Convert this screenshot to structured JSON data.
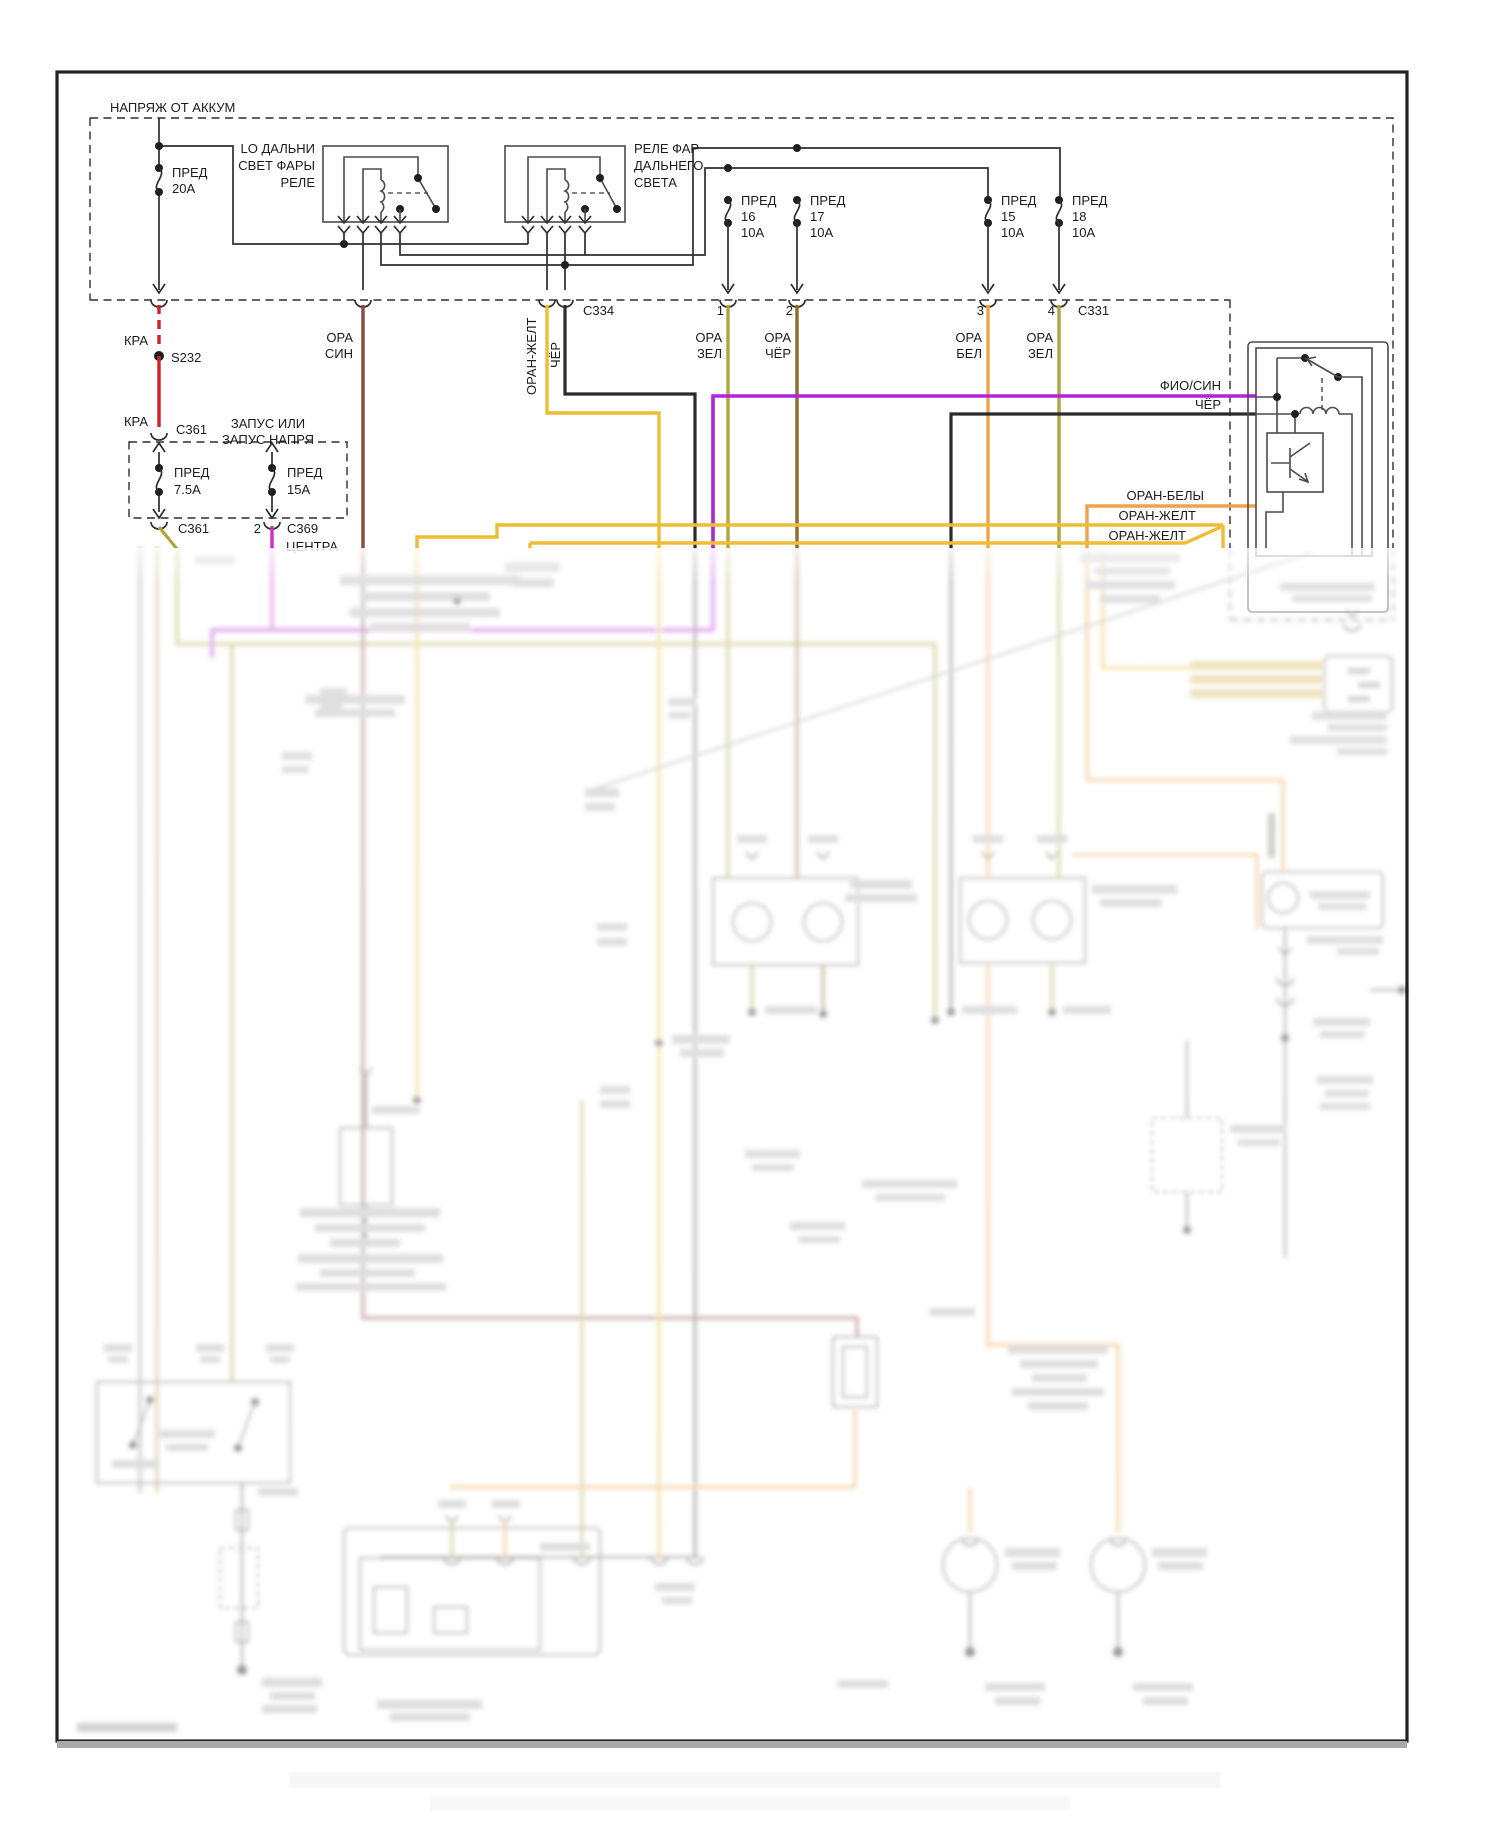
{
  "diagram": {
    "power_box_label": "НАПРЯЖ ОТ АККУМ",
    "fuse20": {
      "l1": "ПРЕД",
      "l2": "20А"
    },
    "relay_low": {
      "l1": "LO ДАЛЬНИ",
      "l2": "СВЕТ ФАРЫ",
      "l3": "РЕЛЕ"
    },
    "relay_high": {
      "l1": "РЕЛЕ ФАР",
      "l2": "ДАЛЬНЕГО",
      "l3": "СВЕТА"
    },
    "fuse16": {
      "l1": "ПРЕД",
      "l2": "16",
      "l3": "10А"
    },
    "fuse17": {
      "l1": "ПРЕД",
      "l2": "17",
      "l3": "10А"
    },
    "fuse15": {
      "l1": "ПРЕД",
      "l2": "15",
      "l3": "10А"
    },
    "fuse18": {
      "l1": "ПРЕД",
      "l2": "18",
      "l3": "10А"
    },
    "c334": "C334",
    "c331": "C331",
    "pin1": "1",
    "pin2": "2",
    "pin3": "3",
    "pin4": "4",
    "kra_upper": "КРА",
    "kra_lower": "КРА",
    "s232": "S232",
    "c361_upper": "C361",
    "start_box": {
      "l1": "ЗАПУС ИЛИ",
      "l2": "ЗАПУС НАПРЯ"
    },
    "fuse75": {
      "l1": "ПРЕД",
      "l2": "7.5А"
    },
    "fuse15a": {
      "l1": "ПРЕД",
      "l2": "15А"
    },
    "c361_lower": "C361",
    "pin2b": "2",
    "c369": "C369",
    "centra": "ЦЕНТРА",
    "ora_sin": {
      "l1": "ОРА",
      "l2": "СИН"
    },
    "oran_zhelt_vert": "ОРАН-ЖЕЛТ",
    "cher_vert": "ЧЁР",
    "ora_zel_1": {
      "l1": "ОРА",
      "l2": "ЗЕЛ"
    },
    "ora_cher": {
      "l1": "ОРА",
      "l2": "ЧЁР"
    },
    "ora_bel": {
      "l1": "ОРА",
      "l2": "БЕЛ"
    },
    "ora_zel_2": {
      "l1": "ОРА",
      "l2": "ЗЕЛ"
    },
    "fio_sin": "ФИО/СИН",
    "cher_h": "ЧЁР",
    "oran_bely": "ОРАН-БЕЛЫ",
    "oran_zhelt_1": "ОРАН-ЖЕЛТ",
    "oran_zhelt_2": "ОРАН-ЖЕЛТ",
    "colors": {
      "red": "#cf2127",
      "maroon": "#8a4a42",
      "yellow": "#eebd33",
      "olive": "#b0a43c",
      "brown": "#8d6b2a",
      "orange": "#eda24c",
      "purple": "#b124d8",
      "magenta": "#d12bd1",
      "gold_connector": "#d9c06a",
      "line_black": "#2e2e2e"
    }
  }
}
